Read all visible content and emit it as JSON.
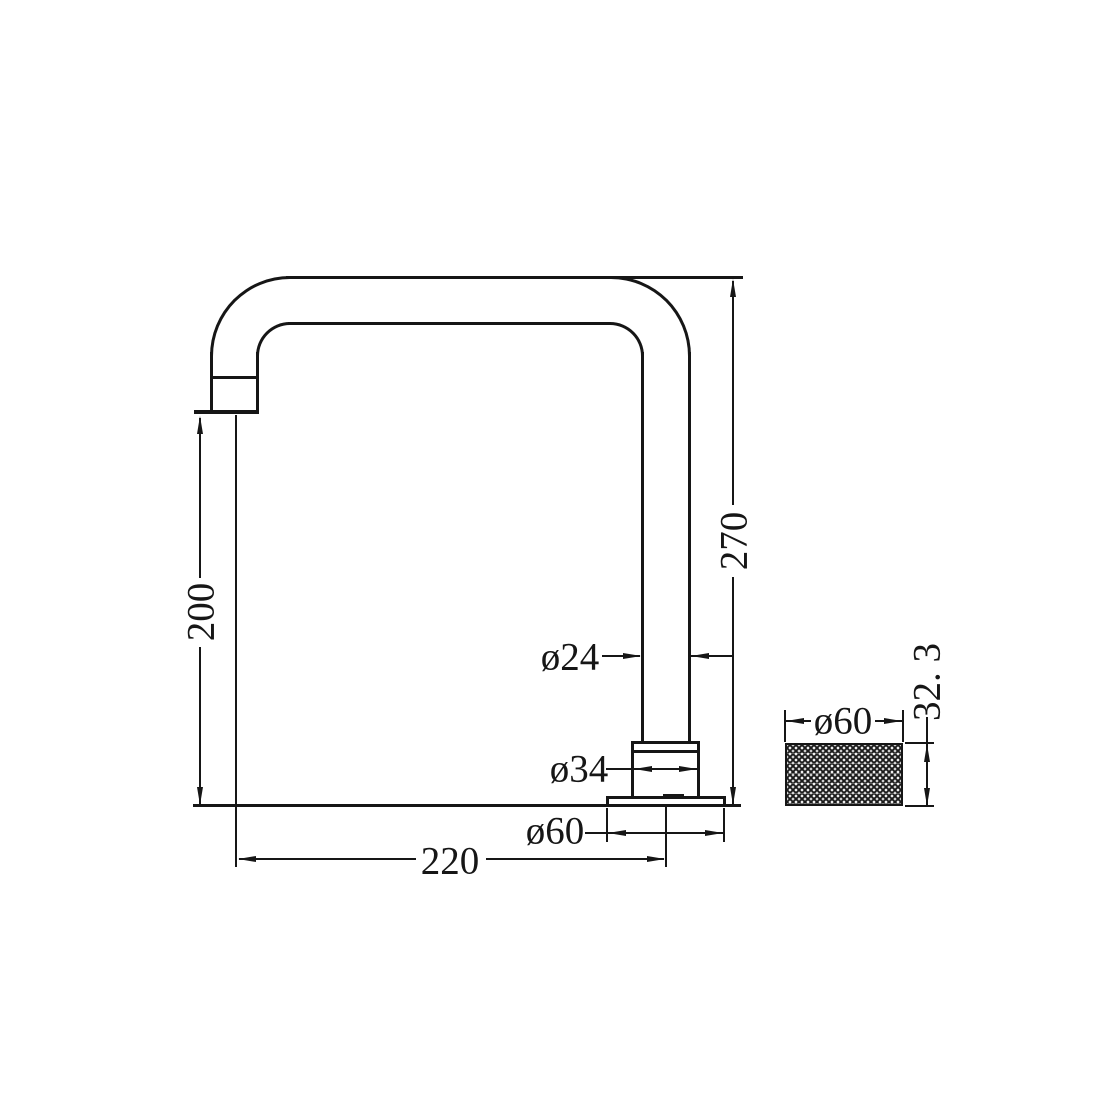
{
  "drawing": {
    "type": "technical-dimension-drawing",
    "subject": "gooseneck faucet spout, side elevation with knurled handle detail",
    "colors": {
      "line": "#161616",
      "background": "#ffffff"
    },
    "dims": {
      "overall_height": "270",
      "outlet_height": "200",
      "reach": "220",
      "pipe_diameter": "ø24",
      "shank_diameter": "ø34",
      "base_diameter": "ø60",
      "handle_diameter": "ø60",
      "handle_height": "32. 3"
    }
  }
}
